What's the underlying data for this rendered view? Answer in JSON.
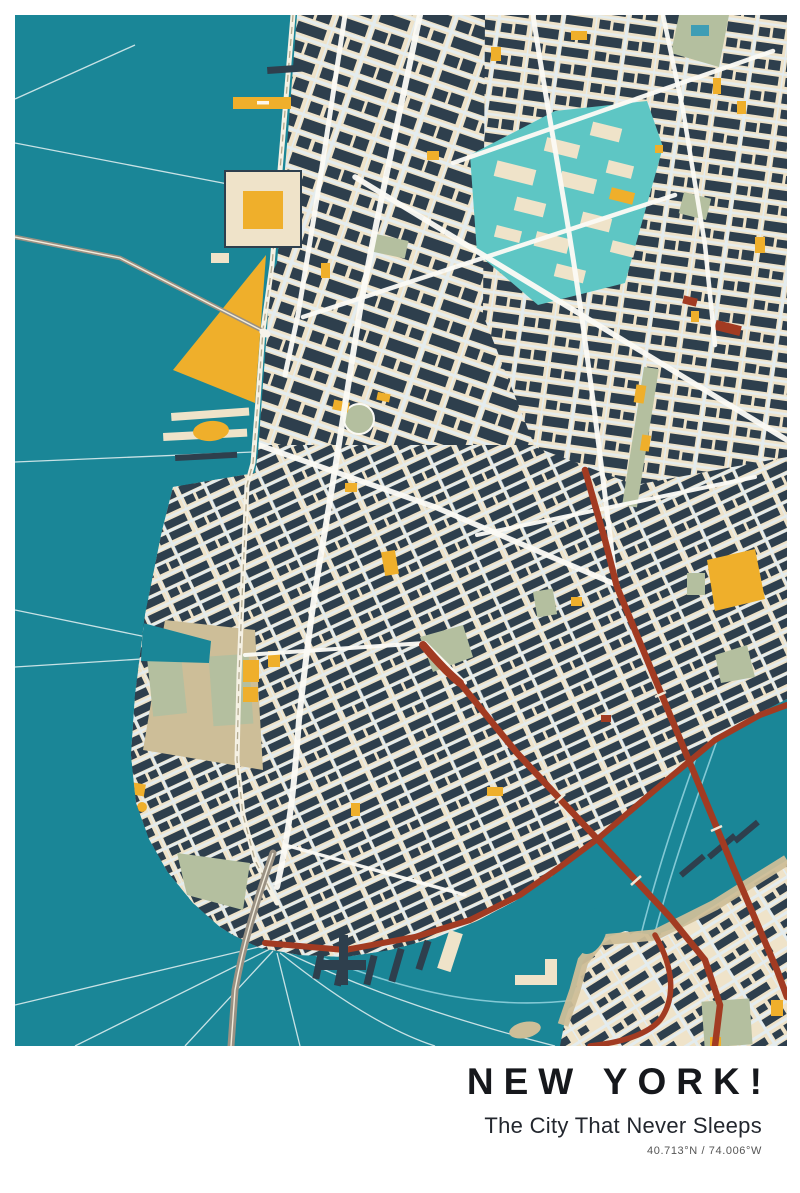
{
  "poster": {
    "title": "NEW YORK!",
    "subtitle": "The City That Never Sleeps",
    "coordinates": "40.713°N / 74.006°W"
  },
  "map": {
    "depicts": "Stylized street map of Lower Manhattan with Hudson River, East River, Brooklyn Bridge, Manhattan Bridge and Brooklyn waterfront",
    "palette": {
      "water": "#1A8697",
      "land": "#EFE3C9",
      "building": "#2E3F4D",
      "street": "#E4ECEE",
      "accent_yellow": "#EFAF2B",
      "accent_red": "#A23B22",
      "park_sage": "#B4BF9F",
      "highlight_turquoise": "#5EC6C4",
      "shore_tan": "#CDBE98",
      "ferry_line": "#E8F2F2",
      "title_color": "#16181C",
      "subtitle_color": "#23272E",
      "coords_color": "#555555",
      "frame": "#FFFFFF"
    }
  }
}
